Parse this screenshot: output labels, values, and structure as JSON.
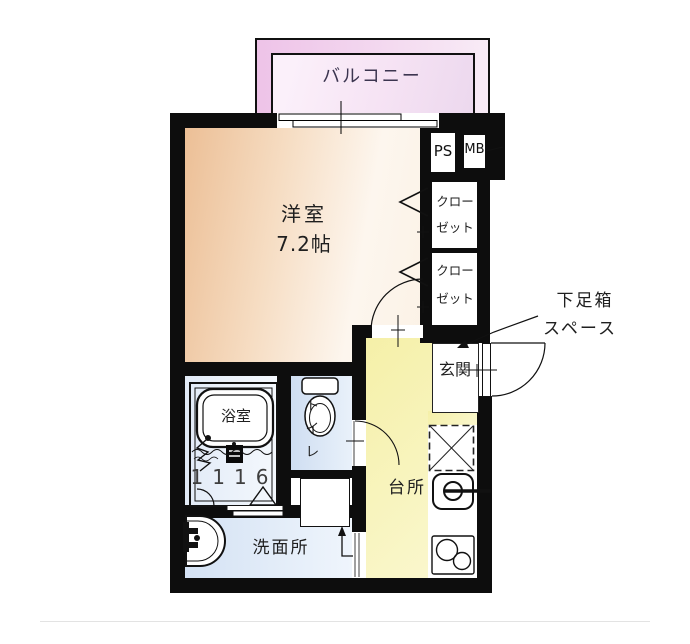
{
  "floorplan": {
    "balcony": "バルコニー",
    "room": "洋室",
    "room_size": "7.2帖",
    "ps": "PS",
    "mb": "MB",
    "closet_upper": {
      "line1": "クロー",
      "line2": "ゼット"
    },
    "closet_lower": {
      "line1": "クロー",
      "line2": "ゼット"
    },
    "shoebox": {
      "line1": "下足箱",
      "line2": "スペース"
    },
    "entrance": "玄関",
    "bathroom": "浴室",
    "bathroom_unit_size": "1116",
    "toilet": "トイレ",
    "kitchen": "台所",
    "washroom": "洗面所"
  },
  "colors": {
    "wall": "#0d0d0d",
    "room_fill": "#ecbf96",
    "balcony_fill": "#f2c7eb",
    "kitchen_fill": "#f5f0a8",
    "water_fill": "#d4e2f4"
  }
}
